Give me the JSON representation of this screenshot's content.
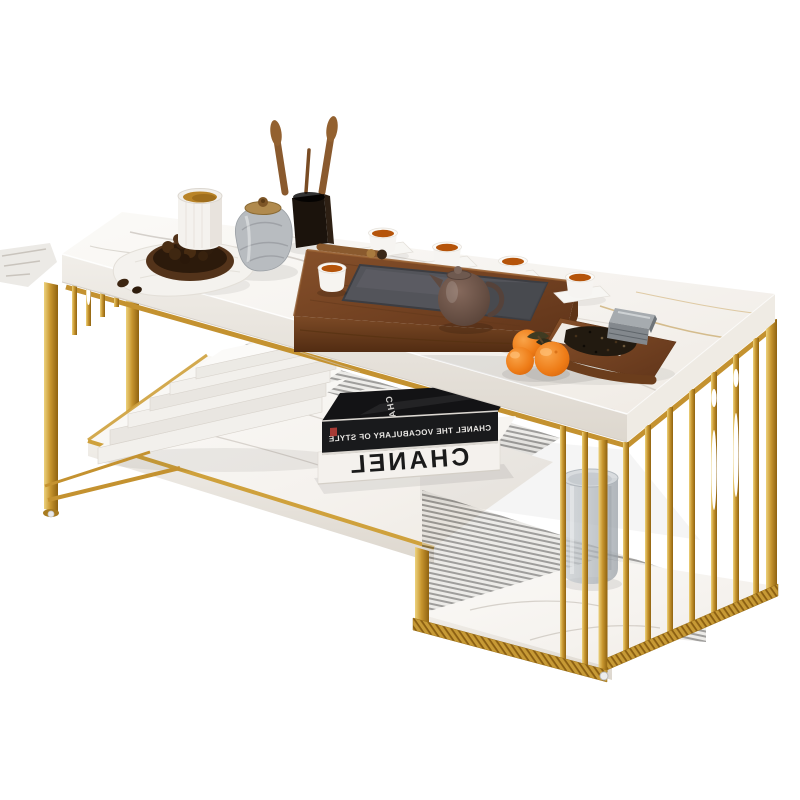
{
  "scene": {
    "description": "Product photo of a modern two-tier rectangular coffee table with white marble surfaces and a gold metal slat frame, styled with a walnut tea ceremony tray, teapot, teacups, books, a glass vase and mandarin oranges on a plain white background.",
    "background_color": "#ffffff"
  },
  "table": {
    "top_material": "white marble",
    "frame_material": "gold metal",
    "tier_count": "2",
    "colors": {
      "gold": "#c79a35",
      "gold_light": "#edd27c",
      "gold_dark": "#8f6210",
      "marble": "#f7f5f2",
      "marble_vein": "#b3aca4",
      "marble_gold_vein": "#c09a4e"
    }
  },
  "books": {
    "spine_title": "CHANEL",
    "spine_subtitle": "CHANEL THE VOCABULARY OF STYLE",
    "cover_title": "CHANEL",
    "white_book_count": "6",
    "text_rendering": "spine text appears mirrored in the photo"
  },
  "tea_set": {
    "teacup_count": "5",
    "teapot_color": "#6e594f",
    "tea_color": "#b5540a",
    "tray_wood_color": "#754322",
    "slate_inset_color": "#53545a"
  },
  "fruit": {
    "orange_count": "3",
    "orange_color": "#ee7c17"
  }
}
